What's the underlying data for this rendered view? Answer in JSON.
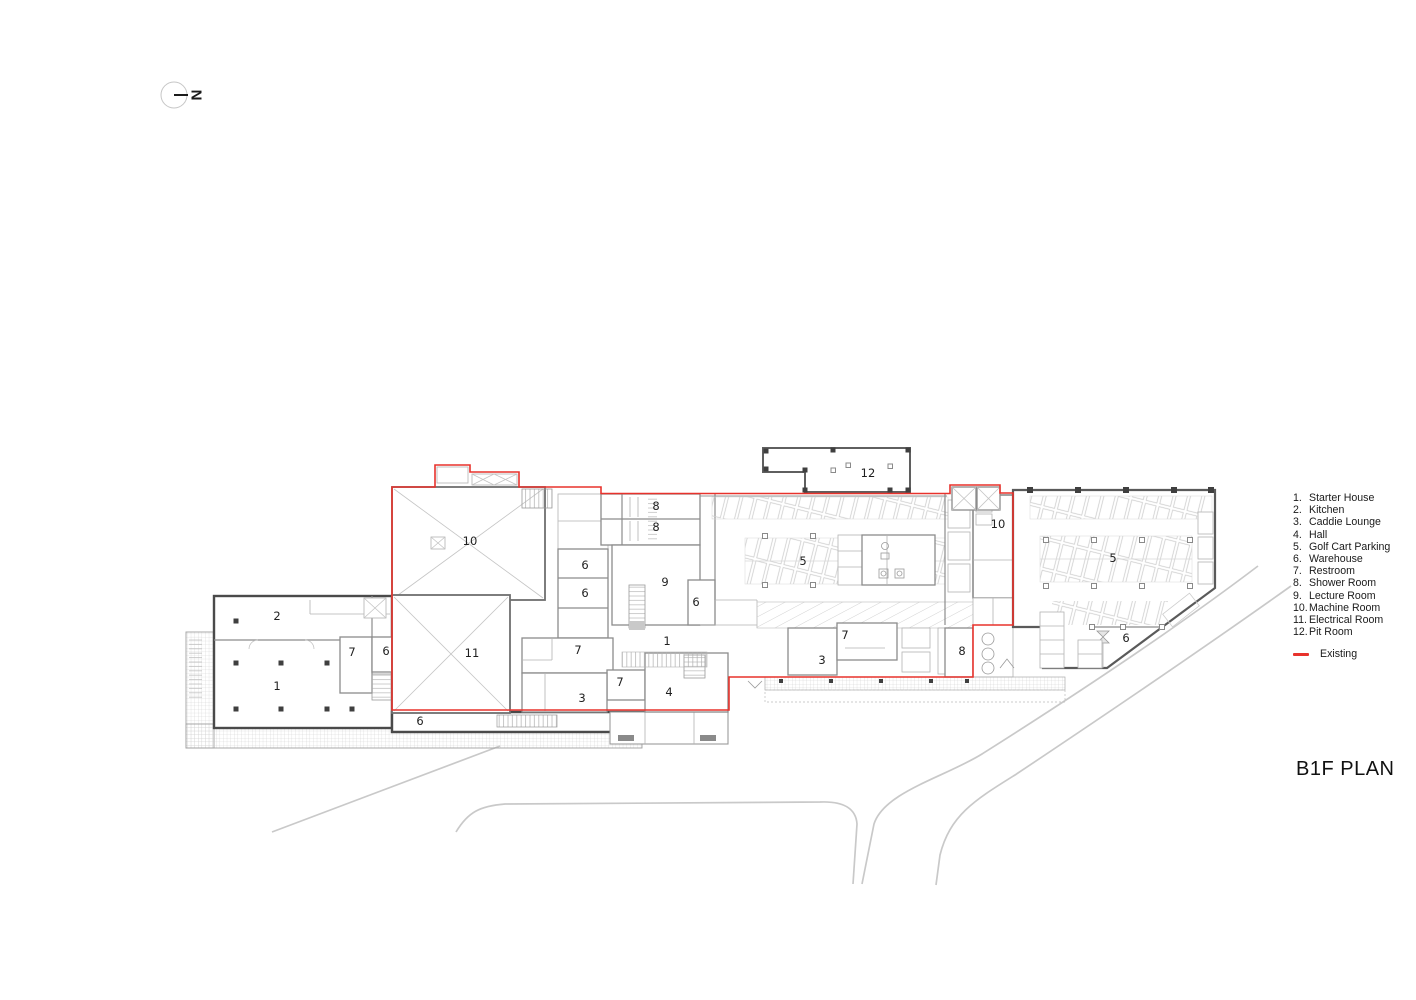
{
  "title": "B1F PLAN",
  "north": {
    "label": "N"
  },
  "legend": {
    "items": [
      {
        "num": "1.",
        "label": "Starter House"
      },
      {
        "num": "2.",
        "label": "Kitchen"
      },
      {
        "num": "3.",
        "label": "Caddie Lounge"
      },
      {
        "num": "4.",
        "label": "Hall"
      },
      {
        "num": "5.",
        "label": "Golf Cart Parking"
      },
      {
        "num": "6.",
        "label": "Warehouse"
      },
      {
        "num": "7.",
        "label": "Restroom"
      },
      {
        "num": "8.",
        "label": "Shower Room"
      },
      {
        "num": "9.",
        "label": "Lecture Room"
      },
      {
        "num": "10.",
        "label": "Machine Room"
      },
      {
        "num": "11.",
        "label": "Electrical Room"
      },
      {
        "num": "12.",
        "label": "Pit Room"
      }
    ],
    "existing": {
      "label": "Existing",
      "color": "#e8322c"
    }
  },
  "plan": {
    "room_labels": [
      {
        "text": "2",
        "x": 277,
        "y": 616
      },
      {
        "text": "1",
        "x": 277,
        "y": 686
      },
      {
        "text": "7",
        "x": 352,
        "y": 652
      },
      {
        "text": "6",
        "x": 386,
        "y": 651
      },
      {
        "text": "10",
        "x": 470,
        "y": 541
      },
      {
        "text": "11",
        "x": 472,
        "y": 653
      },
      {
        "text": "6",
        "x": 585,
        "y": 565
      },
      {
        "text": "6",
        "x": 585,
        "y": 593
      },
      {
        "text": "6",
        "x": 420,
        "y": 721
      },
      {
        "text": "8",
        "x": 656,
        "y": 506
      },
      {
        "text": "8",
        "x": 656,
        "y": 527
      },
      {
        "text": "9",
        "x": 665,
        "y": 582
      },
      {
        "text": "6",
        "x": 696,
        "y": 602
      },
      {
        "text": "1",
        "x": 667,
        "y": 641
      },
      {
        "text": "7",
        "x": 578,
        "y": 650
      },
      {
        "text": "7",
        "x": 620,
        "y": 682
      },
      {
        "text": "3",
        "x": 582,
        "y": 698
      },
      {
        "text": "4",
        "x": 669,
        "y": 692
      },
      {
        "text": "12",
        "x": 868,
        "y": 473
      },
      {
        "text": "5",
        "x": 803,
        "y": 561
      },
      {
        "text": "7",
        "x": 845,
        "y": 635
      },
      {
        "text": "3",
        "x": 822,
        "y": 660
      },
      {
        "text": "8",
        "x": 962,
        "y": 651
      },
      {
        "text": "10",
        "x": 998,
        "y": 524
      },
      {
        "text": "5",
        "x": 1113,
        "y": 558
      },
      {
        "text": "6",
        "x": 1126,
        "y": 638
      }
    ]
  }
}
